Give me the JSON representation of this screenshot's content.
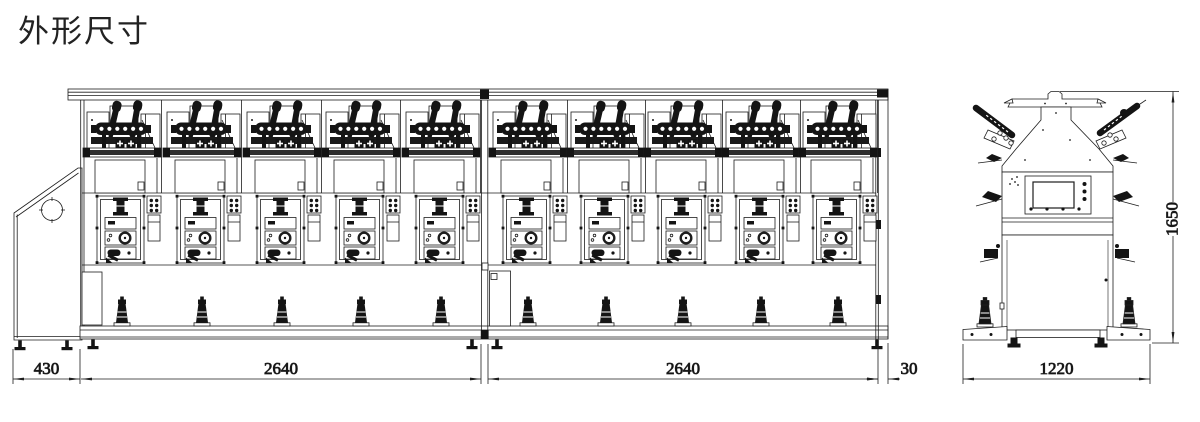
{
  "title": "外形尺寸",
  "front_view": {
    "unit_count": 10,
    "sections": 2,
    "units_per_section": 5,
    "dimensions": {
      "left_end": "430",
      "section_1": "2640",
      "section_2": "2640",
      "right_end": "30"
    }
  },
  "side_view": {
    "dimensions": {
      "width": "1220",
      "height": "1650"
    }
  },
  "colors": {
    "line": "#1d1d1d",
    "fill_dark": "#141414",
    "background": "#ffffff",
    "title_text": "#222222"
  }
}
